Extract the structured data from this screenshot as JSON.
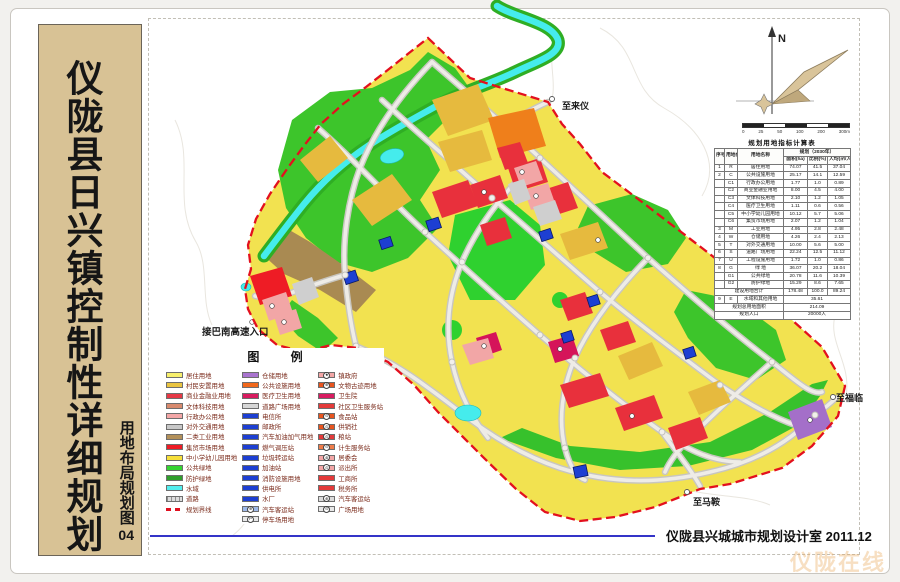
{
  "sidebar": {
    "title": "仪陇县日兴镇控制性详细规划",
    "subtitle": "用地布局规划图",
    "subtitle_number": "04"
  },
  "compass": {
    "n": "N"
  },
  "scalebar": {
    "labels": [
      "0",
      "25",
      "50",
      "100",
      "200",
      "300m"
    ]
  },
  "legend": {
    "title": "图 例",
    "columns": [
      [
        {
          "label": "居住用地",
          "color": "#f7ef6d"
        },
        {
          "label": "村民安置用地",
          "color": "#e9c441"
        },
        {
          "label": "商业金融业用地",
          "color": "#e63946"
        },
        {
          "label": "文体科技用地",
          "color": "#d88a6e"
        },
        {
          "label": "行政办公用地",
          "color": "#f3a6a6"
        },
        {
          "label": "对外交通用地",
          "color": "#c8c8c8"
        },
        {
          "label": "二类工业用地",
          "color": "#b3905a"
        },
        {
          "label": "集贸市场用地",
          "color": "#ee1c25"
        },
        {
          "label": "中小学幼儿园用地",
          "color": "#f6df3a"
        },
        {
          "label": "公共绿地",
          "color": "#35d431"
        },
        {
          "label": "防护绿地",
          "color": "#2f9e2b"
        },
        {
          "label": "水域",
          "color": "#52eeee"
        },
        {
          "label": "道路",
          "kind": "road"
        },
        {
          "label": "规划界线",
          "kind": "dash"
        }
      ],
      [
        {
          "label": "仓储用地",
          "color": "#a974cf"
        },
        {
          "label": "公共设施用地",
          "color": "#f1681c"
        },
        {
          "label": "医疗卫生用地",
          "color": "#d81b60"
        },
        {
          "label": "道路广场用地",
          "color": "#d7d7d7"
        },
        {
          "label": "电信所",
          "color": "#1d3fd2"
        },
        {
          "label": "邮政所",
          "color": "#1d3fd2"
        },
        {
          "label": "汽车加油加气用地",
          "color": "#1d3fd2"
        },
        {
          "label": "燃气调压站",
          "color": "#1d3fd2"
        },
        {
          "label": "垃圾转运站",
          "color": "#1d3fd2"
        },
        {
          "label": "加油站",
          "color": "#1d3fd2"
        },
        {
          "label": "消防设施用地",
          "color": "#1d3fd2"
        },
        {
          "label": "供电所",
          "color": "#1d3fd2"
        },
        {
          "label": "水厂",
          "color": "#1d3fd2"
        },
        {
          "label": "汽车客运站",
          "color": "#9db8e8",
          "sym": "⊕"
        },
        {
          "label": "停车场用地",
          "color": "#e8e8e8",
          "sym": "P"
        }
      ],
      [
        {
          "label": "镇政府",
          "color": "#f3a6a6",
          "sym": "★"
        },
        {
          "label": "文物古迹用地",
          "color": "#e8541f",
          "sym": "⊕"
        },
        {
          "label": "卫生院",
          "color": "#d81b60"
        },
        {
          "label": "社区卫生服务站",
          "color": "#e43a3a"
        },
        {
          "label": "食品站",
          "color": "#e8541f",
          "sym": "⊙"
        },
        {
          "label": "供销社",
          "color": "#e8541f",
          "sym": "⊙"
        },
        {
          "label": "粮站",
          "color": "#e43a3a",
          "sym": "⊙"
        },
        {
          "label": "计生服务站",
          "color": "#ef7c4a",
          "sym": "⊙"
        },
        {
          "label": "居委会",
          "color": "#f3a6a6",
          "sym": "⊛"
        },
        {
          "label": "派出所",
          "color": "#f3a6a6",
          "sym": "⊙"
        },
        {
          "label": "工商所",
          "color": "#e43a3a"
        },
        {
          "label": "税务所",
          "color": "#e43a3a"
        },
        {
          "label": "汽车客运站",
          "color": "#dcdcdc",
          "sym": "⊕"
        },
        {
          "label": "广场用地",
          "color": "#e8e8e8",
          "sym": "⊙"
        }
      ]
    ]
  },
  "table": {
    "title": "规划用地指标计算表",
    "header_row1": [
      [
        "序号",
        1,
        2
      ],
      [
        "用地代号",
        1,
        2
      ],
      [
        "用地名称",
        1,
        2
      ],
      [
        "规划（2030年）",
        3,
        1
      ]
    ],
    "header_row2": [
      [
        "面积(ha)",
        1,
        1
      ],
      [
        "比例(%)",
        1,
        1
      ],
      [
        "人均(㎡/人)",
        1,
        1
      ]
    ],
    "rows": [
      [
        "1",
        "R",
        "居住用地",
        "74.07",
        "41.5",
        "37.04"
      ],
      [
        "2",
        "C",
        "公共设施用地",
        "25.17",
        "14.1",
        "12.59"
      ],
      [
        "",
        "C1",
        "行政办公用地",
        "1.77",
        "1.0",
        "0.89"
      ],
      [
        "",
        "C2",
        "商业金融业用地",
        "8.00",
        "4.5",
        "4.00"
      ],
      [
        "",
        "C3",
        "文体科技用地",
        "2.10",
        "1.2",
        "1.05"
      ],
      [
        "",
        "C4",
        "医疗卫生用地",
        "1.11",
        "0.6",
        "0.56"
      ],
      [
        "",
        "C5",
        "中小学幼儿园用地",
        "10.12",
        "5.7",
        "5.06"
      ],
      [
        "",
        "C6",
        "集贸市场用地",
        "2.07",
        "1.2",
        "1.04"
      ],
      [
        "3",
        "M",
        "工业用地",
        "4.95",
        "2.8",
        "2.48"
      ],
      [
        "4",
        "W",
        "仓储用地",
        "4.26",
        "2.4",
        "2.13"
      ],
      [
        "5",
        "T",
        "对外交通用地",
        "10.00",
        "5.6",
        "5.00"
      ],
      [
        "6",
        "S",
        "道路广场用地",
        "22.24",
        "12.5",
        "11.12"
      ],
      [
        "7",
        "U",
        "工程设施用地",
        "1.72",
        "1.0",
        "0.86"
      ],
      [
        "8",
        "G",
        "绿  地",
        "36.07",
        "20.2",
        "18.04"
      ],
      [
        "",
        "G1",
        "公共绿地",
        "20.78",
        "11.6",
        "10.39"
      ],
      [
        "",
        "G2",
        "防护绿地",
        "15.29",
        "8.6",
        "7.65"
      ],
      [
        [
          "建设用地合计",
          3
        ],
        "178.48",
        "100.0",
        "89.24"
      ],
      [
        "9",
        "E",
        "水域和其他用地",
        [
          "35.61",
          3
        ]
      ],
      [
        [
          "规划总用地面积",
          3
        ],
        [
          "214.09",
          3
        ]
      ],
      [
        [
          "规划人口",
          3
        ],
        [
          "20000人",
          3
        ]
      ]
    ]
  },
  "map_labels": [
    {
      "text": "至来仪",
      "x": 562,
      "y": 99,
      "size": 9
    },
    {
      "text": "接巴南高速入口",
      "x": 202,
      "y": 324,
      "size": 9.5
    },
    {
      "text": "至马鞍",
      "x": 693,
      "y": 495,
      "size": 9
    },
    {
      "text": "至福临",
      "x": 836,
      "y": 391,
      "size": 9
    }
  ],
  "footer": {
    "credit": "仪陇县兴城城市规划设计室  2011.12"
  },
  "watermark": "仪陇在线",
  "colors": {
    "sidebar_bg": "#d8c295",
    "residential_yellow": "#f2e250",
    "resettlement_gold": "#e6ba3e",
    "commercial_red": "#e8303c",
    "market_red": "#ee1c25",
    "medical_crimson": "#d5145a",
    "admin_pink": "#f2a6a6",
    "public_orange": "#ef7f1b",
    "industry_brown": "#a98a52",
    "green_public": "#3dc52b",
    "water_cyan": "#45ecec",
    "utility_blue": "#1d3fd2",
    "warehouse_purple": "#a46fc9",
    "road_gray": "#c8c6c0",
    "boundary_red": "#e3101e",
    "footer_blue": "#3434c8"
  }
}
